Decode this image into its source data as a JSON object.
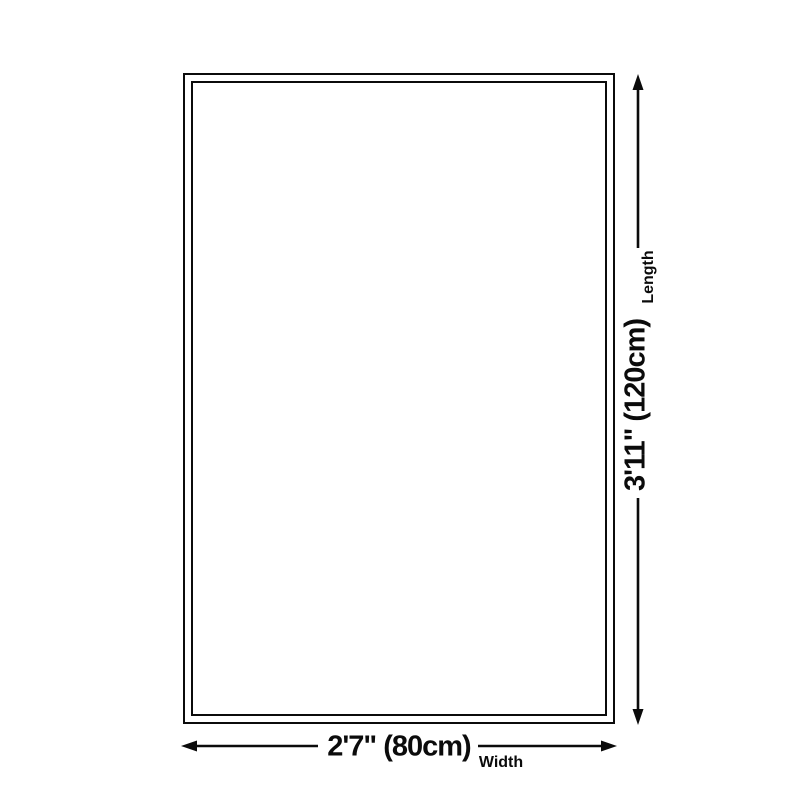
{
  "page": {
    "background_color": "#ffffff",
    "line_color": "#0b0b0b"
  },
  "diagram": {
    "type": "product-size-diagram",
    "shape": "rectangle-outline-double-border",
    "length_dimension": {
      "value": "3'11\" (120cm)",
      "label": "Length",
      "side": "right",
      "orientation": "vertical"
    },
    "width_dimension": {
      "value": "2'7\" (80cm)",
      "label": "Width",
      "side": "bottom",
      "orientation": "horizontal"
    }
  }
}
